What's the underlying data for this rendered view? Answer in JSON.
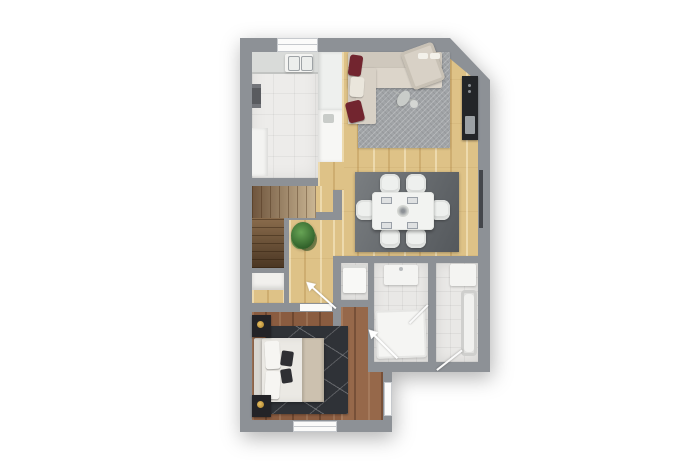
{
  "document": {
    "type": "architectural-floor-plan",
    "view": "top-down-3d-render",
    "text_labels": []
  },
  "palette": {
    "background": "#ffffff",
    "wall": "#8d9196",
    "tile_kitchen": "#edecea",
    "tile_bath": "#e9e8e6",
    "wood_light": "#dec287",
    "wood_dark": "#8a5c40",
    "wood_corridor": "#96684a",
    "rug_living": "#a1a4a7",
    "rug_dining": "#54585c",
    "rug_bedroom": "#2f3237",
    "sofa_beige": "#d8d1c6",
    "pillow_red": "#72252f",
    "tv_black": "#232528",
    "table_white": "#f2f3f1",
    "stairs_brown": "#8a6c4c",
    "plant_green": "#2d5c27",
    "bed_white": "#ebe9e4",
    "throw_beige": "#ccc1af",
    "nightstand_black": "#232327",
    "lamp_gold": "#a77c28",
    "window_white": "#fbfbfa"
  },
  "rooms": [
    {
      "id": "kitchen",
      "floor": "light-tile",
      "position": "top-left"
    },
    {
      "id": "living-room",
      "floor": "light-wood",
      "position": "top-right",
      "corner": "diagonal-cut"
    },
    {
      "id": "dining-area",
      "floor": "light-wood",
      "position": "center-right"
    },
    {
      "id": "staircase-hall",
      "floor": "light-wood",
      "position": "center-left"
    },
    {
      "id": "storage-closet",
      "floor": "light-wood",
      "position": "left-below-stairs"
    },
    {
      "id": "laundry-niche",
      "floor": "white-tile",
      "position": "center"
    },
    {
      "id": "bathroom-small",
      "floor": "white-tile",
      "position": "center-bottom"
    },
    {
      "id": "bathroom-large",
      "floor": "white-tile",
      "position": "bottom-right"
    },
    {
      "id": "bedroom",
      "floor": "dark-wood",
      "position": "bottom-left"
    },
    {
      "id": "corridor-entry",
      "floor": "dark-wood",
      "position": "bottom-center"
    }
  ],
  "furniture": {
    "kitchen": [
      "top-counter-with-double-sink",
      "right-counter-cabinets",
      "left-cabinet",
      "wall-radiator"
    ],
    "living_room": [
      "l-shaped-sectional-sofa",
      "two-red-pillows",
      "white-pillow",
      "chaise-cushion",
      "gray-chevron-rug",
      "small-decor-table",
      "black-tv-console"
    ],
    "dining_area": [
      "white-rect-table",
      "six-white-chairs",
      "four-placemats",
      "centerpiece",
      "dark-gray-rug"
    ],
    "staircase_hall": [
      "l-shaped-staircase",
      "potted-plant"
    ],
    "bedroom": [
      "double-bed-white-duvet",
      "beige-throw",
      "two-dark-accent-pillows",
      "headboard",
      "two-black-nightstands",
      "two-gold-lamps",
      "dark-geometric-rug"
    ],
    "laundry_niche": [
      "washing-machine"
    ],
    "bathroom_small": [
      "wall-sink",
      "shower-tray"
    ],
    "bathroom_large": [
      "vanity",
      "bathtub"
    ]
  },
  "annotations": {
    "door_swing_arrows": 3,
    "door_leaves": 2,
    "windows": [
      "top-wall-window",
      "bottom-wall-window",
      "right-wall-slit"
    ],
    "entry_door": "east-wall-of-entry-corridor"
  }
}
